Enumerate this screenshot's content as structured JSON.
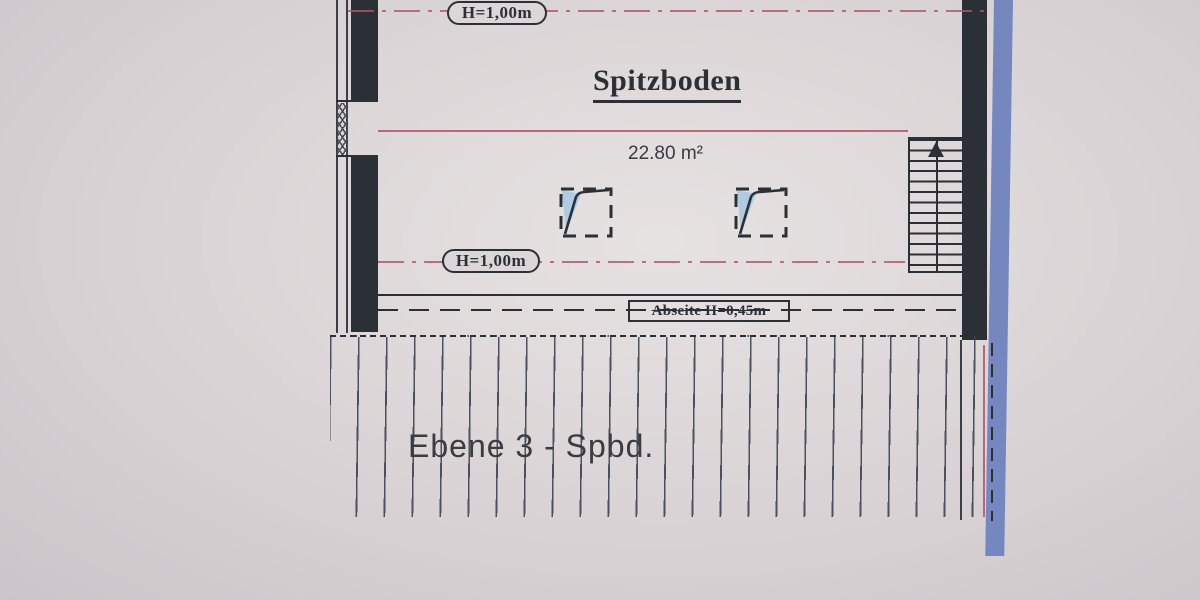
{
  "labels": {
    "height_top": "H=1,00m",
    "height_mid": "H=1,00m",
    "title": "Spitzboden",
    "area": "22.80 m²",
    "abseite": "Abseite H=0,45m",
    "level": "Ebene 3 - Spbd."
  },
  "colors": {
    "paper": "#d9d3d5",
    "ink": "#2b2f36",
    "accent": "#b05468",
    "hatch": "#3d4250",
    "blue": "#7488bf",
    "glass": "#afcbe2"
  }
}
